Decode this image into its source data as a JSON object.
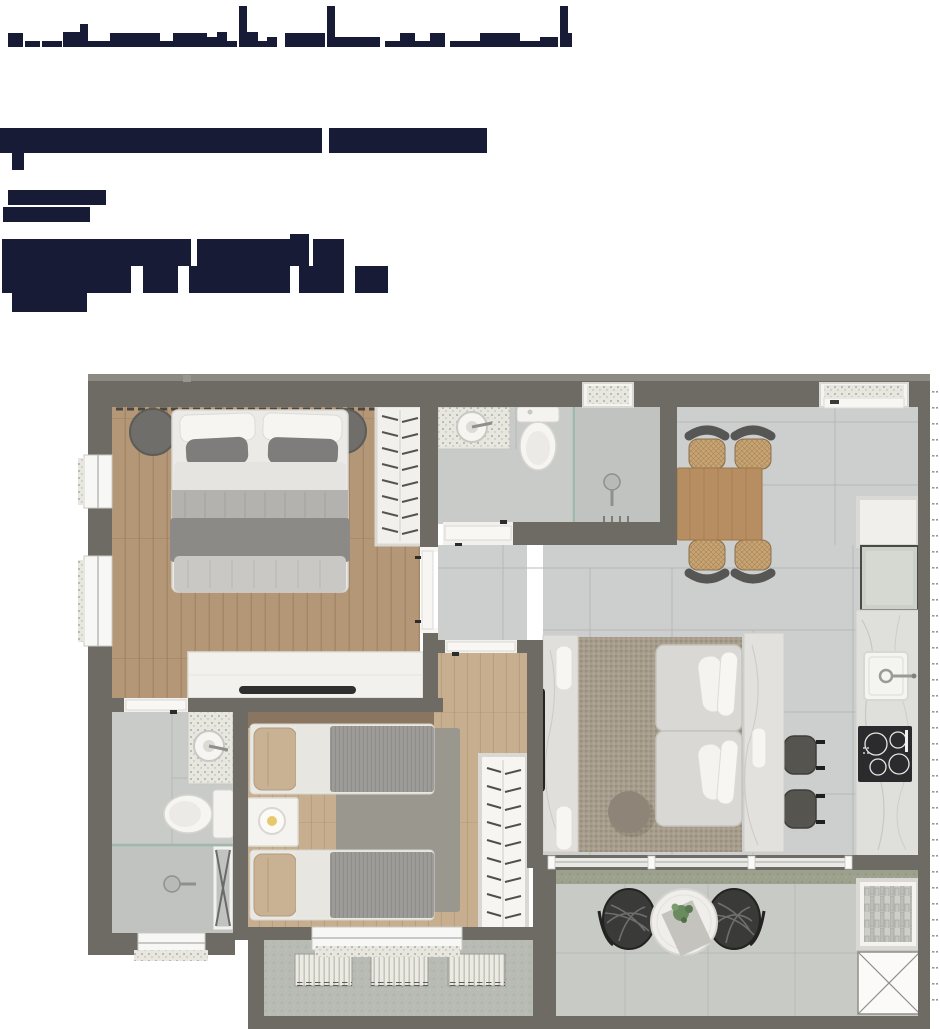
{
  "page": {
    "background": "#ffffff",
    "width": 940,
    "height": 1029
  },
  "header": {
    "text_blocks": [
      {
        "id": "title-top-cropped",
        "legible": false,
        "note_color": "#181b36"
      },
      {
        "id": "subtitle-bar",
        "legible": false
      },
      {
        "id": "small-label",
        "legible": false
      },
      {
        "id": "big-heading-block",
        "legible": false
      }
    ]
  },
  "colors": {
    "text_block": "#181b36",
    "wall": "#6e6a64",
    "wall_cap": "#8d8a83",
    "wood_bedroom1": "#b39776",
    "wood_bedroom2": "#c7ae8e",
    "wood_dark_strip": "#8a7660",
    "tile_light": "#cdcfce",
    "tile_bath": "#c9cbc9",
    "tile_shower": "#c1c3c1",
    "grout": "#b9bbba",
    "rug_living": "#a79d8c",
    "rug_bedroom2": "#9a978f",
    "sofa": "#d9d8d4",
    "marble": "#e0dfdb",
    "table_wood": "#b78e61",
    "rattan_seat": "#c9a472",
    "chair_back": "#565654",
    "cooktop": "#2b2b2d",
    "white_fixture": "#f4f3ef",
    "balcony_sill": "#9ca18d",
    "concrete": "#b8bbb4",
    "glass": "#9fb8ab",
    "lamp_glow": "#e8c96a",
    "dark_accent": "#2f2f2f"
  },
  "floor_plan": {
    "rooms": [
      {
        "name": "bedroom-1",
        "floor": "wood",
        "furniture": [
          "double-bed",
          "pillows",
          "ottoman-left",
          "ottoman-right",
          "open-wardrobe",
          "dresser",
          "tv"
        ]
      },
      {
        "name": "bathroom-1",
        "floor": "tile",
        "furniture": [
          "marble-counter",
          "round-basin",
          "toilet",
          "glass-partition",
          "shower-head",
          "drain"
        ]
      },
      {
        "name": "dining-area",
        "floor": "tile",
        "furniture": [
          "wood-table",
          "rattan-chair",
          "rattan-chair",
          "rattan-chair",
          "rattan-chair"
        ]
      },
      {
        "name": "kitchen",
        "floor": "tile",
        "furniture": [
          "open-shelf",
          "appliance",
          "marble-counter",
          "sink",
          "cooktop",
          "stool",
          "stool"
        ]
      },
      {
        "name": "living-room",
        "floor": "tile",
        "furniture": [
          "tv-console",
          "soundbar",
          "tv",
          "woven-rug",
          "sofa-modules",
          "white-cushions",
          "pouf",
          "marble-console"
        ]
      },
      {
        "name": "bedroom-2",
        "floor": "wood",
        "furniture": [
          "single-bed",
          "single-bed",
          "nightstand",
          "table-lamp",
          "rug",
          "open-wardrobe"
        ]
      },
      {
        "name": "bathroom-2",
        "floor": "tile",
        "furniture": [
          "marble-counter",
          "round-basin",
          "toilet",
          "glass-partition",
          "shower-head",
          "towel-ladder"
        ]
      },
      {
        "name": "balcony",
        "floor": "tile",
        "furniture": [
          "round-table",
          "wire-chair",
          "wire-chair",
          "plant",
          "planter-niche",
          "shaft-x-box"
        ]
      },
      {
        "name": "service-area",
        "floor": "concrete",
        "furniture": [
          "louver-unit",
          "louver-unit",
          "louver-unit"
        ]
      }
    ],
    "openings": [
      "entry-door-top",
      "bedroom1-door",
      "bathroom1-door",
      "bedroom2-door",
      "bathroom2-door",
      "balcony-sliding-door",
      "window-left-1",
      "window-left-2",
      "window-bedroom2",
      "window-bathroom2"
    ]
  }
}
